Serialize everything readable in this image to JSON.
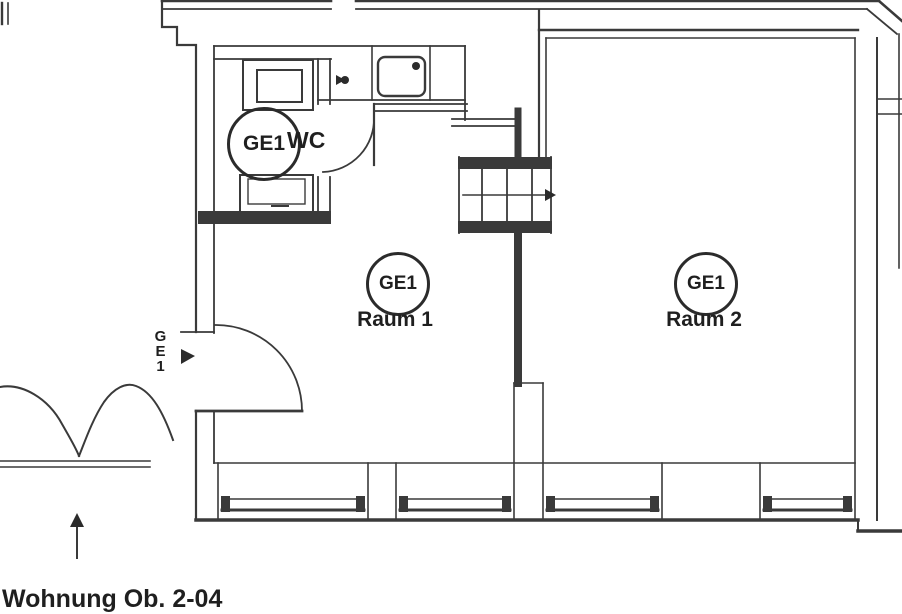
{
  "plan": {
    "type": "architectural-floor-plan",
    "unit_label": "GE1",
    "rooms": [
      {
        "id": "wc",
        "badge": "GE1",
        "name": "WC"
      },
      {
        "id": "raum1",
        "badge": "GE1",
        "name": "Raum 1"
      },
      {
        "id": "raum2",
        "badge": "GE1",
        "name": "Raum 2"
      }
    ],
    "entrance_label": "GE1",
    "caption": "Wohnung Ob. 2-04",
    "colors": {
      "line": "#3a3a3a",
      "text": "#1f1f1f",
      "background": "#ffffff"
    },
    "icons": [
      "stairs-direction-arrow",
      "entrance-arrow",
      "up-arrow",
      "sink",
      "tap",
      "toilet",
      "washbasin"
    ]
  }
}
